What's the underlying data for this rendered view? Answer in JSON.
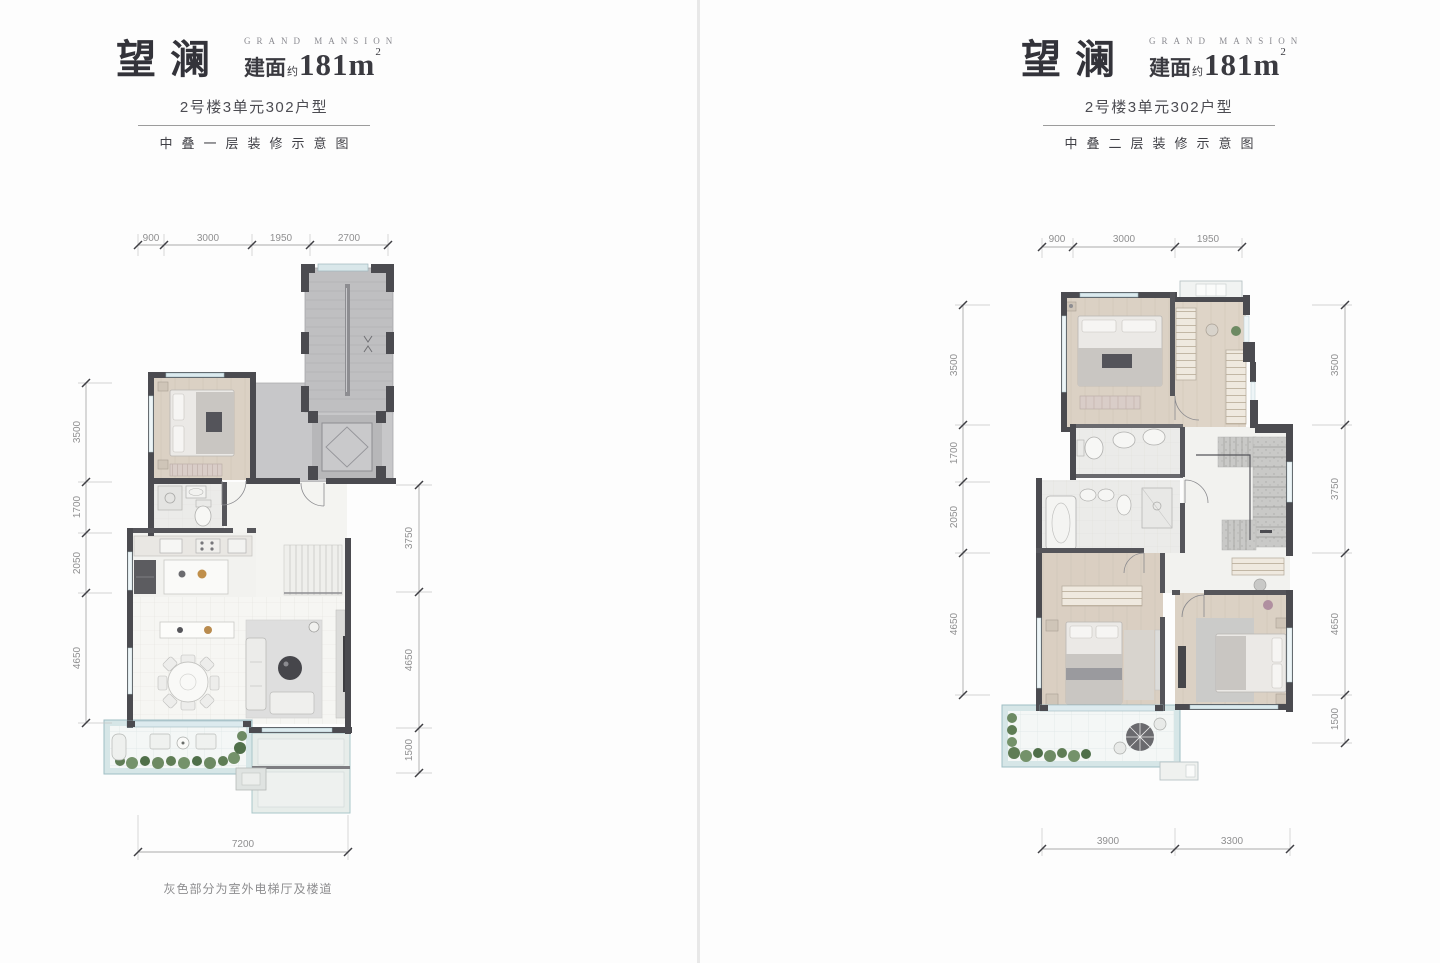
{
  "page": {
    "background": "#fdfdfd",
    "divider_color": "#e8e8e8",
    "wall_color": "#4b4b50",
    "gray_stair_fill": "#c0c0c2",
    "wood_fill": "#dbd1c4",
    "balcony_fill": "#d6e6e7",
    "dim_text_color": "#8f8f90"
  },
  "plans": [
    {
      "title": "望澜",
      "brand": "GRAND MANSION",
      "area_label": "建面",
      "area_about": "约",
      "area_value": "181m",
      "area_sup": "2",
      "unit_type": "2号楼3单元302户型",
      "floor_label": "中叠一层装修示意图",
      "note": "灰色部分为室外电梯厅及楼道",
      "dims": {
        "top": [
          "900",
          "3000",
          "1950",
          "2700"
        ],
        "left": [
          "3500",
          "1700",
          "2050",
          "4650"
        ],
        "right": [
          "3750",
          "4650",
          "1500"
        ],
        "bottom": [
          "7200"
        ]
      }
    },
    {
      "title": "望澜",
      "brand": "GRAND MANSION",
      "area_label": "建面",
      "area_about": "约",
      "area_value": "181m",
      "area_sup": "2",
      "unit_type": "2号楼3单元302户型",
      "floor_label": "中叠二层装修示意图",
      "note": "",
      "dims": {
        "top": [
          "900",
          "3000",
          "1950"
        ],
        "left": [
          "3500",
          "1700",
          "2050",
          "4650"
        ],
        "right": [
          "3500",
          "3750",
          "4650",
          "1500"
        ],
        "bottom": [
          "3900",
          "3300"
        ]
      }
    }
  ]
}
